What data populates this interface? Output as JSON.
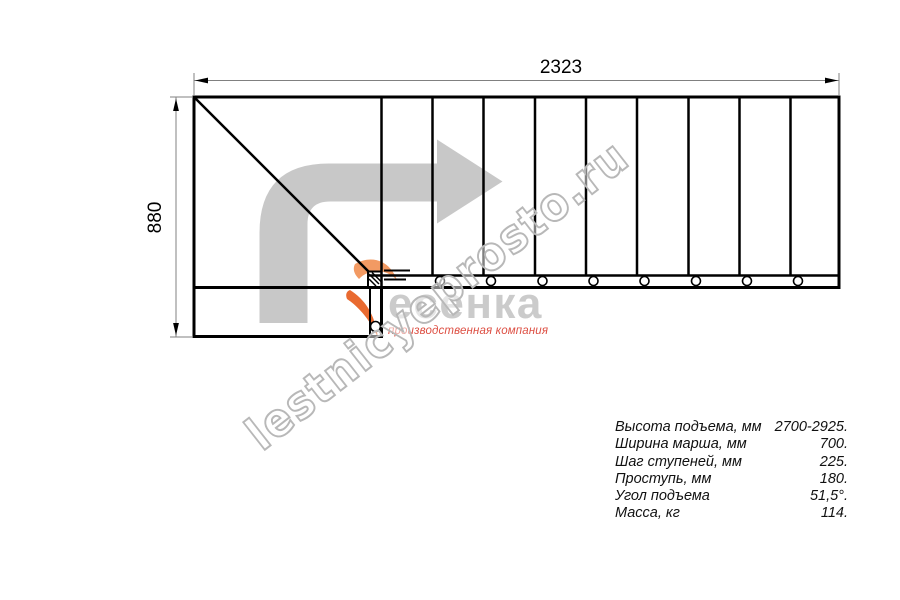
{
  "drawing": {
    "width_dim": "2323",
    "height_dim": "880",
    "straight_treads": 9,
    "bolt_holes": 9,
    "line_color": "#000000",
    "dim_line_color": "#808080",
    "arrow_fill": "#c8c8c8"
  },
  "logo": {
    "brand": "есенка",
    "tagline": "производственная компания",
    "accent_color": "#e96a30",
    "brand_color": "#cbcbcb",
    "tagline_color": "#dd4f43"
  },
  "watermark": {
    "text": "lestnicyeprosto.ru",
    "color": "#b8b8b8"
  },
  "specs": {
    "rows": [
      {
        "label": "Высота подъема, мм",
        "value": "2700-2925."
      },
      {
        "label": "Ширина марша, мм",
        "value": "700."
      },
      {
        "label": "Шаг ступеней, мм",
        "value": "225."
      },
      {
        "label": "Проступь, мм",
        "value": "180."
      },
      {
        "label": "Угол подъема",
        "value": "51,5°."
      },
      {
        "label": "Масса, кг",
        "value": "114."
      }
    ]
  }
}
